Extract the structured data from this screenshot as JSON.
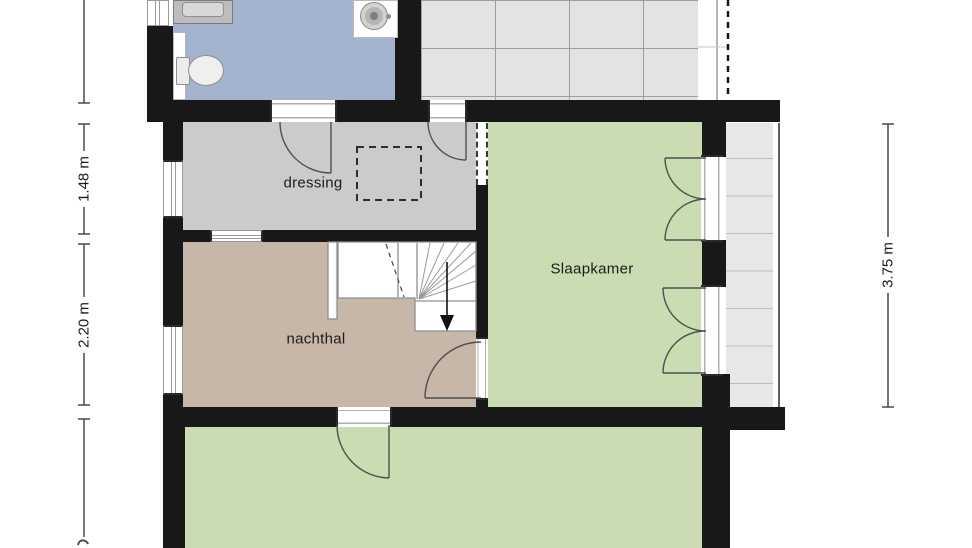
{
  "plan": {
    "rooms": [
      {
        "id": "dressing",
        "label": "dressing"
      },
      {
        "id": "nachthal",
        "label": "nachthal"
      },
      {
        "id": "slaapkamer",
        "label": "Slaapkamer"
      }
    ],
    "dimensions": [
      {
        "id": "dim-left-upper",
        "label": "1.48 m"
      },
      {
        "id": "dim-left-lower",
        "label": "2.20 m"
      },
      {
        "id": "dim-right",
        "label": "3.75 m"
      }
    ]
  },
  "colors": {
    "wall": "#181818",
    "bathroom": "#a4b4ce",
    "dressing": "#cbcbcb",
    "nachthal": "#c7b7a8",
    "bedroom": "#c9dcb2",
    "terrace": "#e3e3e3",
    "tileband": "#e7e7e7",
    "annotation": "#4a4a4a"
  }
}
